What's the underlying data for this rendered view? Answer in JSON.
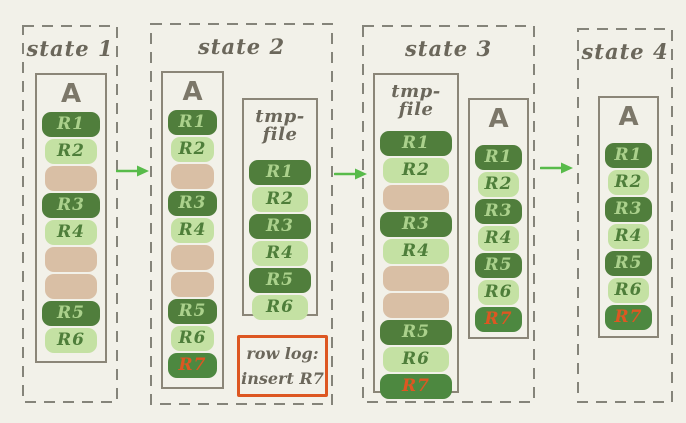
{
  "colors": {
    "bg": "#f2f1e9",
    "dark": "#507e3c",
    "light": "#c4e1a3",
    "tan": "#d9bfa5",
    "new": "#4d8840",
    "on_dark": "#abd18c",
    "on_light": "#4e7e3a",
    "accent": "#dd5722",
    "arrow": "#58bb4a",
    "panel_border": "#85847a",
    "box_border": "#8b8678",
    "label": "#6b675b",
    "title": "#7c7769"
  },
  "states": [
    {
      "label": "state 1",
      "files": [
        {
          "title": "A",
          "blocks": [
            {
              "label": "R1",
              "type": "dark"
            },
            {
              "label": "R2",
              "type": "light"
            },
            {
              "label": "",
              "type": "tan"
            },
            {
              "label": "R3",
              "type": "dark"
            },
            {
              "label": "R4",
              "type": "light"
            },
            {
              "label": "",
              "type": "tan"
            },
            {
              "label": "",
              "type": "tan"
            },
            {
              "label": "R5",
              "type": "dark"
            },
            {
              "label": "R6",
              "type": "light"
            }
          ]
        }
      ]
    },
    {
      "label": "state 2",
      "files": [
        {
          "title": "A",
          "blocks": [
            {
              "label": "R1",
              "type": "dark"
            },
            {
              "label": "R2",
              "type": "light"
            },
            {
              "label": "",
              "type": "tan"
            },
            {
              "label": "R3",
              "type": "dark"
            },
            {
              "label": "R4",
              "type": "light"
            },
            {
              "label": "",
              "type": "tan"
            },
            {
              "label": "",
              "type": "tan"
            },
            {
              "label": "R5",
              "type": "dark"
            },
            {
              "label": "R6",
              "type": "light"
            },
            {
              "label": "R7",
              "type": "new"
            }
          ]
        },
        {
          "title": "tmp-file",
          "blocks": [
            {
              "label": "R1",
              "type": "dark"
            },
            {
              "label": "R2",
              "type": "light"
            },
            {
              "label": "R3",
              "type": "dark"
            },
            {
              "label": "R4",
              "type": "light"
            },
            {
              "label": "R5",
              "type": "dark"
            },
            {
              "label": "R6",
              "type": "light"
            }
          ]
        }
      ],
      "note": {
        "line1": "row log:",
        "line2": "insert R7"
      }
    },
    {
      "label": "state 3",
      "files": [
        {
          "title": "tmp-file",
          "blocks": [
            {
              "label": "R1",
              "type": "dark"
            },
            {
              "label": "R2",
              "type": "light"
            },
            {
              "label": "",
              "type": "tan"
            },
            {
              "label": "R3",
              "type": "dark"
            },
            {
              "label": "R4",
              "type": "light"
            },
            {
              "label": "",
              "type": "tan"
            },
            {
              "label": "",
              "type": "tan"
            },
            {
              "label": "R5",
              "type": "dark"
            },
            {
              "label": "R6",
              "type": "light"
            },
            {
              "label": "R7",
              "type": "new"
            }
          ]
        },
        {
          "title": "A",
          "blocks": [
            {
              "label": "R1",
              "type": "dark"
            },
            {
              "label": "R2",
              "type": "light"
            },
            {
              "label": "R3",
              "type": "dark"
            },
            {
              "label": "R4",
              "type": "light"
            },
            {
              "label": "R5",
              "type": "dark"
            },
            {
              "label": "R6",
              "type": "light"
            },
            {
              "label": "R7",
              "type": "new"
            }
          ]
        }
      ]
    },
    {
      "label": "state 4",
      "files": [
        {
          "title": "A",
          "blocks": [
            {
              "label": "R1",
              "type": "dark"
            },
            {
              "label": "R2",
              "type": "light"
            },
            {
              "label": "R3",
              "type": "dark"
            },
            {
              "label": "R4",
              "type": "light"
            },
            {
              "label": "R5",
              "type": "dark"
            },
            {
              "label": "R6",
              "type": "light"
            },
            {
              "label": "R7",
              "type": "new"
            }
          ]
        }
      ]
    }
  ]
}
